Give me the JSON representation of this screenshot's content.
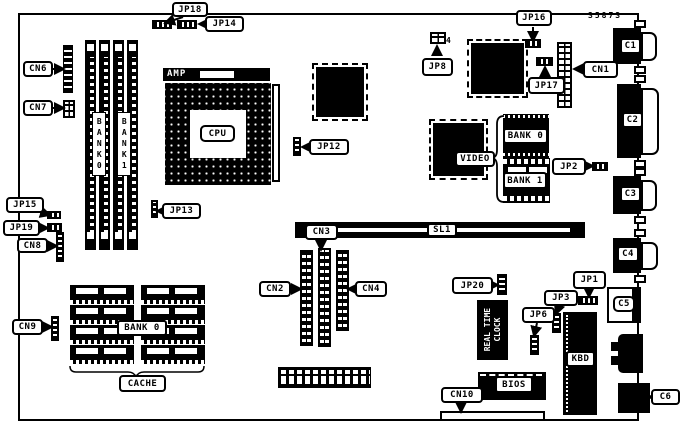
{
  "colors": {
    "ink": "#000000",
    "paper": "#ffffff"
  },
  "board": {
    "part_number": "35873",
    "jp8_pin_count": "4"
  },
  "labels": {
    "jp18": "JP18",
    "jp14": "JP14",
    "jp16": "JP16",
    "jp8": "JP8",
    "jp17": "JP17",
    "cn1": "CN1",
    "cn6": "CN6",
    "cn7": "CN7",
    "amp": "AMP",
    "cpu": "CPU",
    "jp12": "JP12",
    "video": "VIDEO",
    "bank0_mem": "BANK 0",
    "bank1_mem": "BANK 1",
    "jp2": "JP2",
    "c1": "C1",
    "c2": "C2",
    "c3": "C3",
    "c4": "C4",
    "c5": "C5",
    "c6": "C6",
    "jp15": "JP15",
    "jp19": "JP19",
    "cn8": "CN8",
    "jp13": "JP13",
    "cn9": "CN9",
    "dimm_bank0": "BANK0",
    "dimm_bank1": "BANK1",
    "cn2": "CN2",
    "cn3": "CN3",
    "cn4": "CN4",
    "sl1": "SL1",
    "bank0_cache": "BANK 0",
    "cache": "CACHE",
    "jp20": "JP20",
    "jp1": "JP1",
    "jp3": "JP3",
    "jp6": "JP6",
    "rtc_line1": "REAL TIME",
    "rtc_line2": "CLOCK",
    "bios": "BIOS",
    "kbd": "KBD",
    "cn10": "CN10"
  }
}
